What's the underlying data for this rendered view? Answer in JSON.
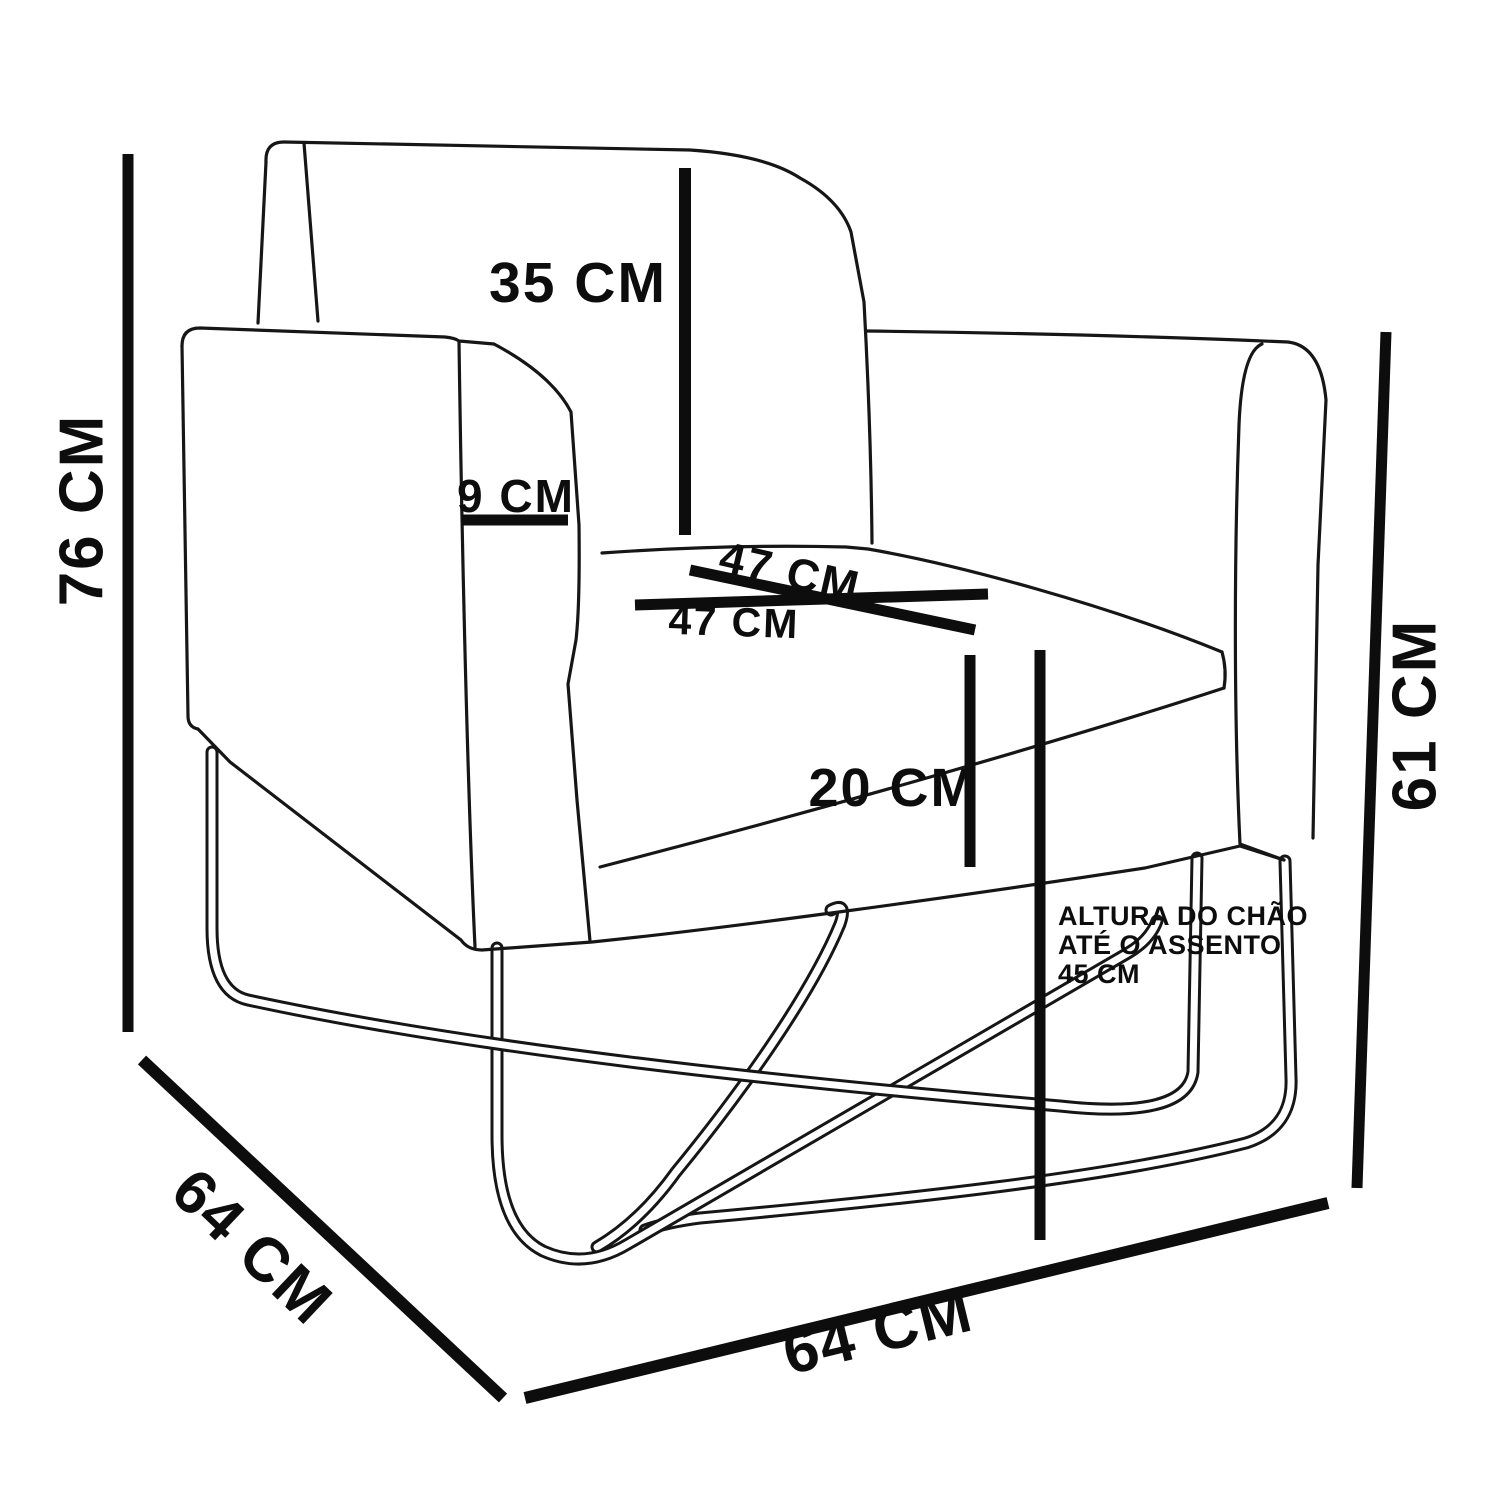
{
  "page": {
    "background_color": "#ffffff",
    "ink_color": "#0d0d0d",
    "content_type": "armchair dimension diagram"
  },
  "diagram": {
    "product": "armchair with metal x-frame base",
    "unit": "CM",
    "labels": {
      "height_total": "76 CM",
      "depth_side": "64 CM",
      "width_front": "64 CM",
      "arm_height": "61 CM",
      "backrest_height": "35 CM",
      "arm_width": "9 CM",
      "seat_width_upper": "47 CM",
      "seat_width_lower": "47 CM",
      "cushion_thickness": "20 CM",
      "floor_note_line1": "ALTURA DO CHÃO",
      "floor_note_line2": "ATÉ O ASSENTO",
      "floor_note_line3": "45 CM"
    },
    "values": {
      "height_total_cm": 76,
      "depth_cm": 64,
      "width_cm": 64,
      "arm_height_cm": 61,
      "backrest_height_cm": 35,
      "arm_width_cm": 9,
      "seat_width_cm": 47,
      "seat_depth_cm": 47,
      "cushion_thickness_cm": 20,
      "floor_to_seat_cm": 45
    }
  }
}
